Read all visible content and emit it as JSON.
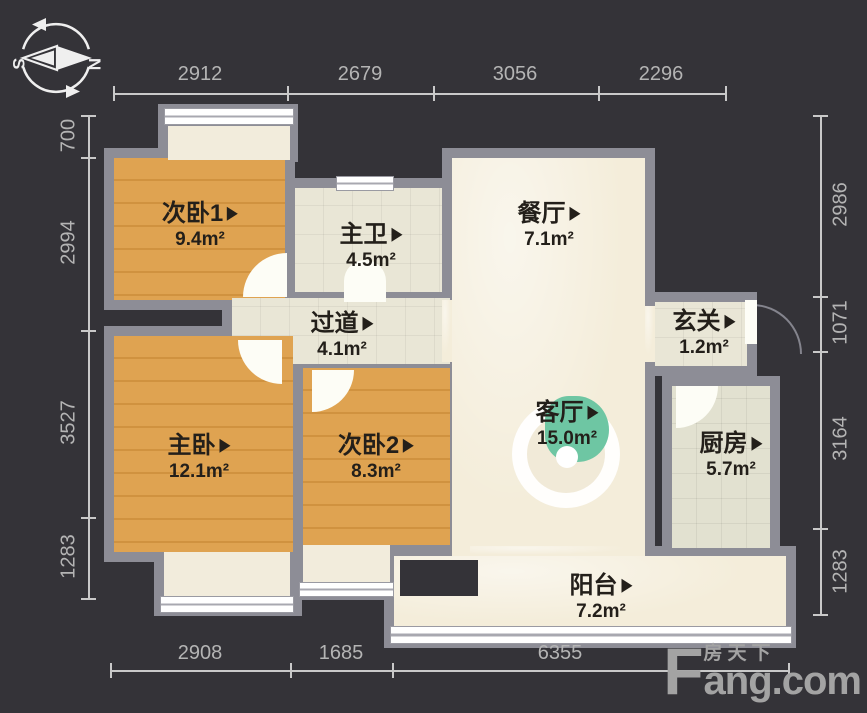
{
  "compass": {
    "south_label": "S",
    "north_label": "N"
  },
  "rooms": [
    {
      "id": "bed1",
      "name": "次卧1",
      "area": "9.4m²"
    },
    {
      "id": "bath",
      "name": "主卫",
      "area": "4.5m²"
    },
    {
      "id": "dining",
      "name": "餐厅",
      "area": "7.1m²"
    },
    {
      "id": "corridor",
      "name": "过道",
      "area": "4.1m²"
    },
    {
      "id": "entry",
      "name": "玄关",
      "area": "1.2m²"
    },
    {
      "id": "master",
      "name": "主卧",
      "area": "12.1m²"
    },
    {
      "id": "bed2",
      "name": "次卧2",
      "area": "8.3m²"
    },
    {
      "id": "living",
      "name": "客厅",
      "area": "15.0m²"
    },
    {
      "id": "kitchen",
      "name": "厨房",
      "area": "5.7m²"
    },
    {
      "id": "balcony",
      "name": "阳台",
      "area": "7.2m²"
    }
  ],
  "dimensions": {
    "top": [
      "2912",
      "2679",
      "3056",
      "2296"
    ],
    "left": [
      "700",
      "2994",
      "3527",
      "1283"
    ],
    "right": [
      "2986",
      "1071",
      "3164",
      "1283"
    ],
    "bottom": [
      "2908",
      "1685",
      "6355"
    ]
  },
  "logo": {
    "f": "F",
    "cn": "房天下",
    "en": "ang.com"
  },
  "colors": {
    "bg": "#343338",
    "wall": "#8d8d96",
    "wood": "#dfa351",
    "wood_line": "#d0923f",
    "marble": "#f4edda",
    "tile": "#e9e6d6",
    "tile2": "#e2e1d0",
    "cream": "#f2ecdc",
    "window": "#ffffff",
    "green": "#6ec6a3",
    "dim": "#c9c9c9",
    "dim_text": "#b4b4b4",
    "label": "#231f1a",
    "logo": "#a3a3a3",
    "door": "#fdfdf6"
  }
}
